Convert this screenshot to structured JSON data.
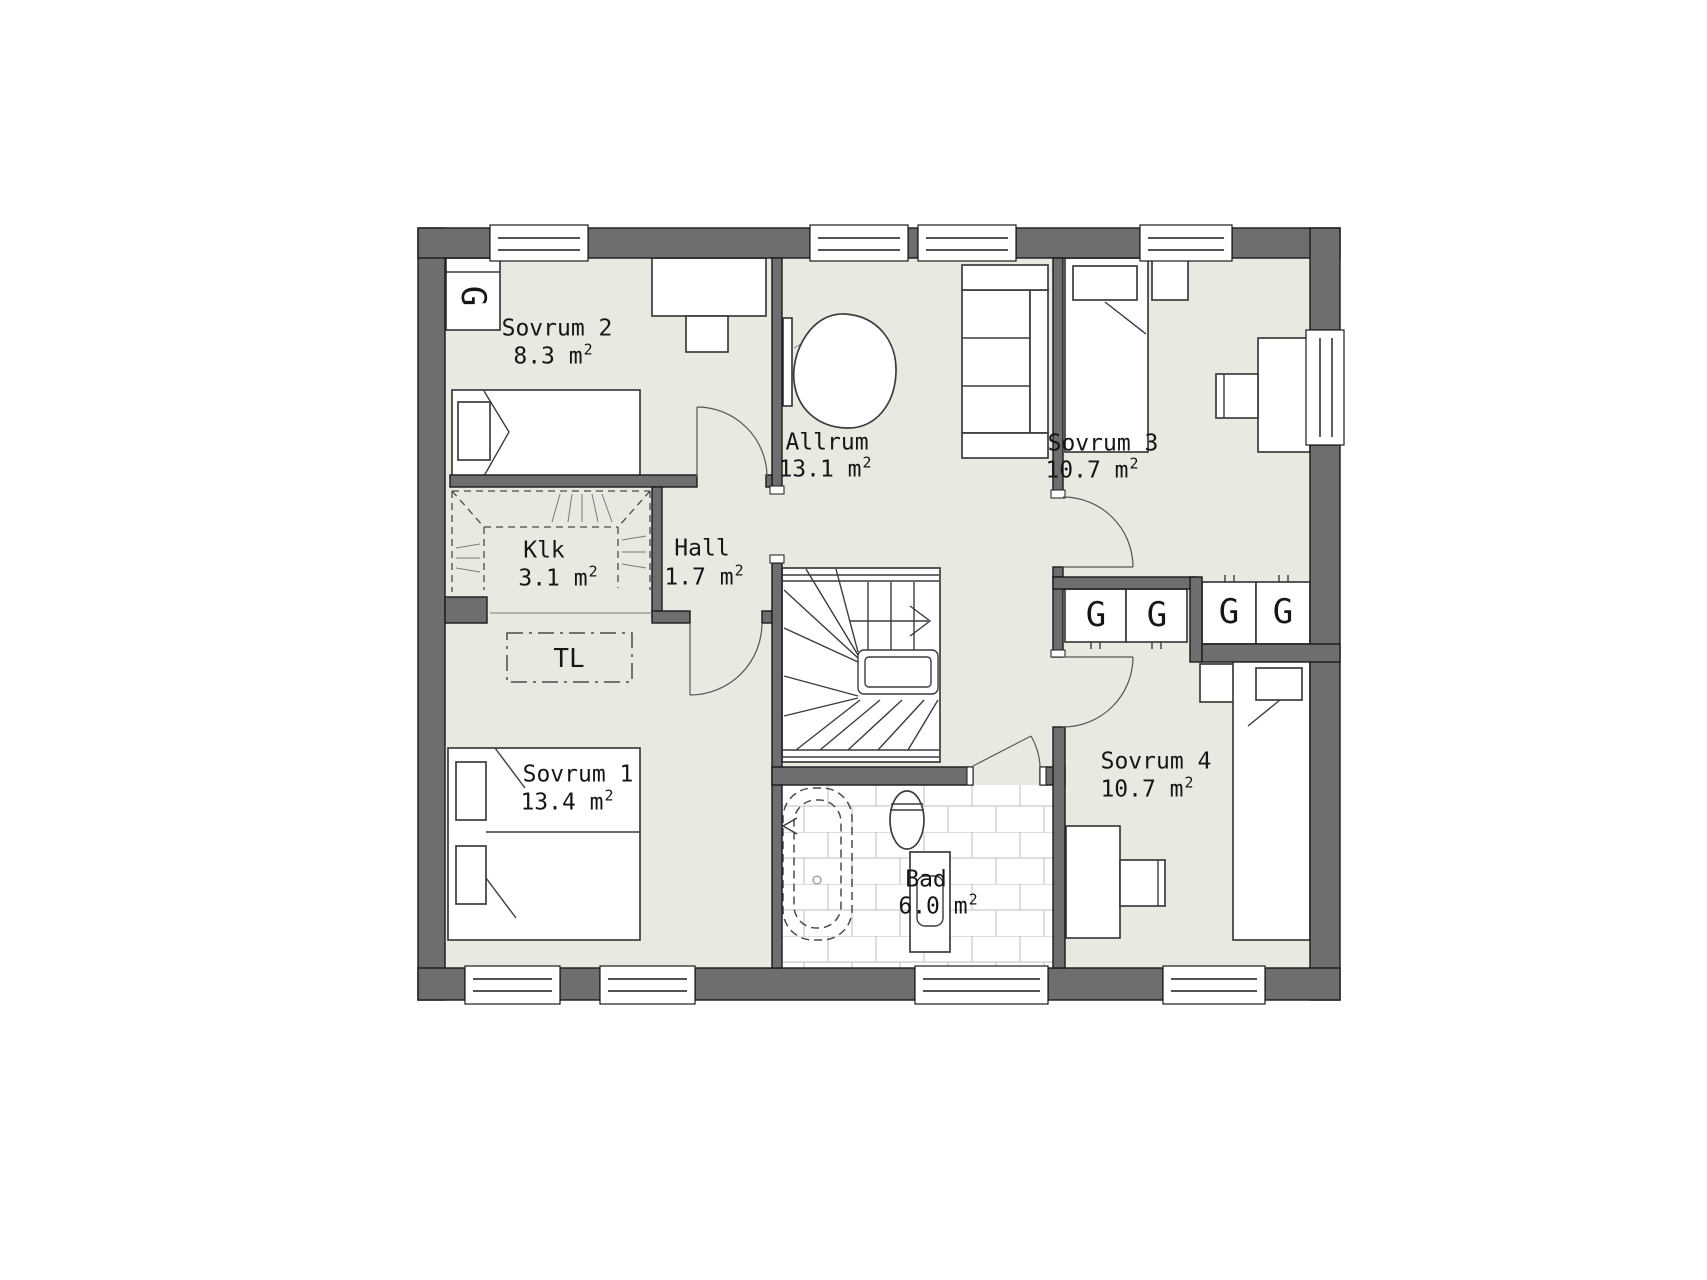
{
  "theme": {
    "wall": "#6e6e6e",
    "floor": "#e9e8e1",
    "bad_floor": "#ffffff",
    "line": "#1a1a1a",
    "tile_line": "#c9c9c3",
    "furniture_line": "#3c3c3c"
  },
  "rooms": {
    "sovrum2": {
      "name": "Sovrum 2",
      "area": "8.3 m",
      "sup": "2"
    },
    "allrum": {
      "name": "Allrum",
      "area": "13.1 m",
      "sup": "2"
    },
    "sovrum3": {
      "name": "Sovrum 3",
      "area": "10.7 m",
      "sup": "2"
    },
    "klk": {
      "name": "Klk",
      "area": "3.1 m",
      "sup": "2"
    },
    "hall": {
      "name": "Hall",
      "area": "1.7 m",
      "sup": "2"
    },
    "sovrum1": {
      "name": "Sovrum 1",
      "area": "13.4 m",
      "sup": "2"
    },
    "bad": {
      "name": "Bad",
      "area": "6.0 m",
      "sup": "2"
    },
    "sovrum4": {
      "name": "Sovrum 4",
      "area": "10.7 m",
      "sup": "2"
    }
  },
  "markers": {
    "wardrobe": "G",
    "attic_hatch": "TL"
  },
  "symbols": [
    "staircase-up-arrow-icon",
    "double-bed-icon",
    "single-bed-icon",
    "sofa-icon",
    "tv-icon",
    "desk-icon",
    "chair-icon",
    "bathtub-icon",
    "toilet-icon",
    "washbasin-icon",
    "wardrobe-icon",
    "clothes-rail-icon",
    "window-icon",
    "door-swing-icon",
    "attic-hatch-icon"
  ]
}
